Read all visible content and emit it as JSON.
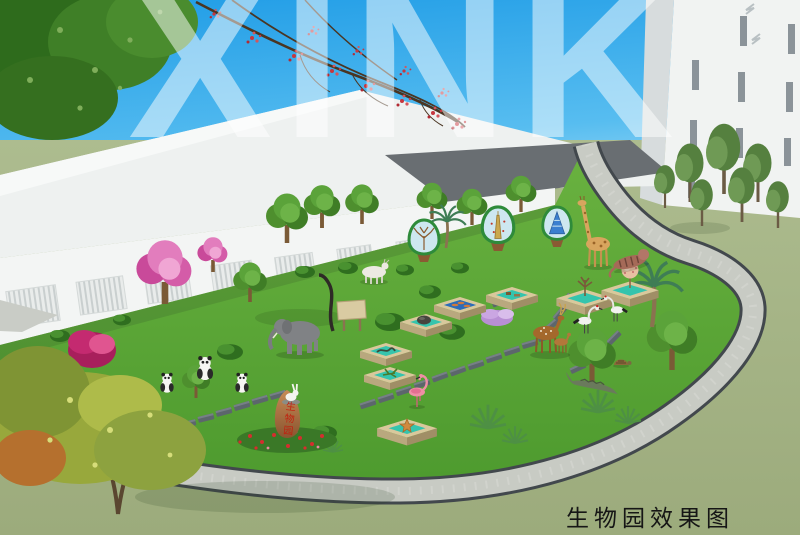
{
  "scene": {
    "watermark_text": "XINK",
    "caption_text": "生物园效果图",
    "rock_inscription": "生物园",
    "description": "Aerial concept rendering of a school biology garden with animal statues, specimen display platforms and a looping gravel path"
  },
  "palette": {
    "sky_top": "#1f9ce6",
    "sky_horizon": "#c3e8f8",
    "roof_light": "#eef1f0",
    "roof_dark": "#696e72",
    "wall_white": "#f3f5f4",
    "garden_green": "#58a335",
    "outer_lawn": "#a7b78a",
    "path_gravel": "#c8cbc4",
    "path_edge": "#42484d",
    "platform_tan": "#d9c89c",
    "platform_teal": "#35c4ad",
    "rock_brown": "#b07a4a",
    "flower_red": "#d42e2e",
    "blossom_pink": "#e27dbd",
    "bush_magenta": "#c42a70",
    "autumn_yellow": "#a8b545"
  },
  "inventory": {
    "animal_statues": [
      "panda group (3)",
      "elephant",
      "white goat",
      "giraffe",
      "reclining tiger",
      "deer with fawn",
      "red-crowned cranes (2)",
      "flamingo",
      "rabbit",
      "crocodile",
      "tortoise"
    ],
    "exhibits": [
      "evolution-tree display board on stump",
      "species-tree display board on stump",
      "ecology-pyramid display board on stump",
      "fossil specimen platform",
      "fish specimen platform",
      "artifact specimen platform",
      "snake specimen platform",
      "grasshopper specimen platform",
      "starfish specimen platform",
      "planter box with sapling",
      "planter box with flowering tree",
      "wooden sign with branch sculpture",
      "inscribed garden stone with red flower bed"
    ],
    "landscape": [
      "looping gravel walkway",
      "stepping-stone trails",
      "pink flowering trees",
      "magenta shrub",
      "yellow-green foreground tree",
      "overhanging canopy",
      "red blossom branches",
      "palm tree",
      "yucca clusters",
      "ball shrubs"
    ]
  },
  "buildings": [
    "single-storey hall with white pitched roof and louvered windows",
    "white high-rise tower at right"
  ]
}
